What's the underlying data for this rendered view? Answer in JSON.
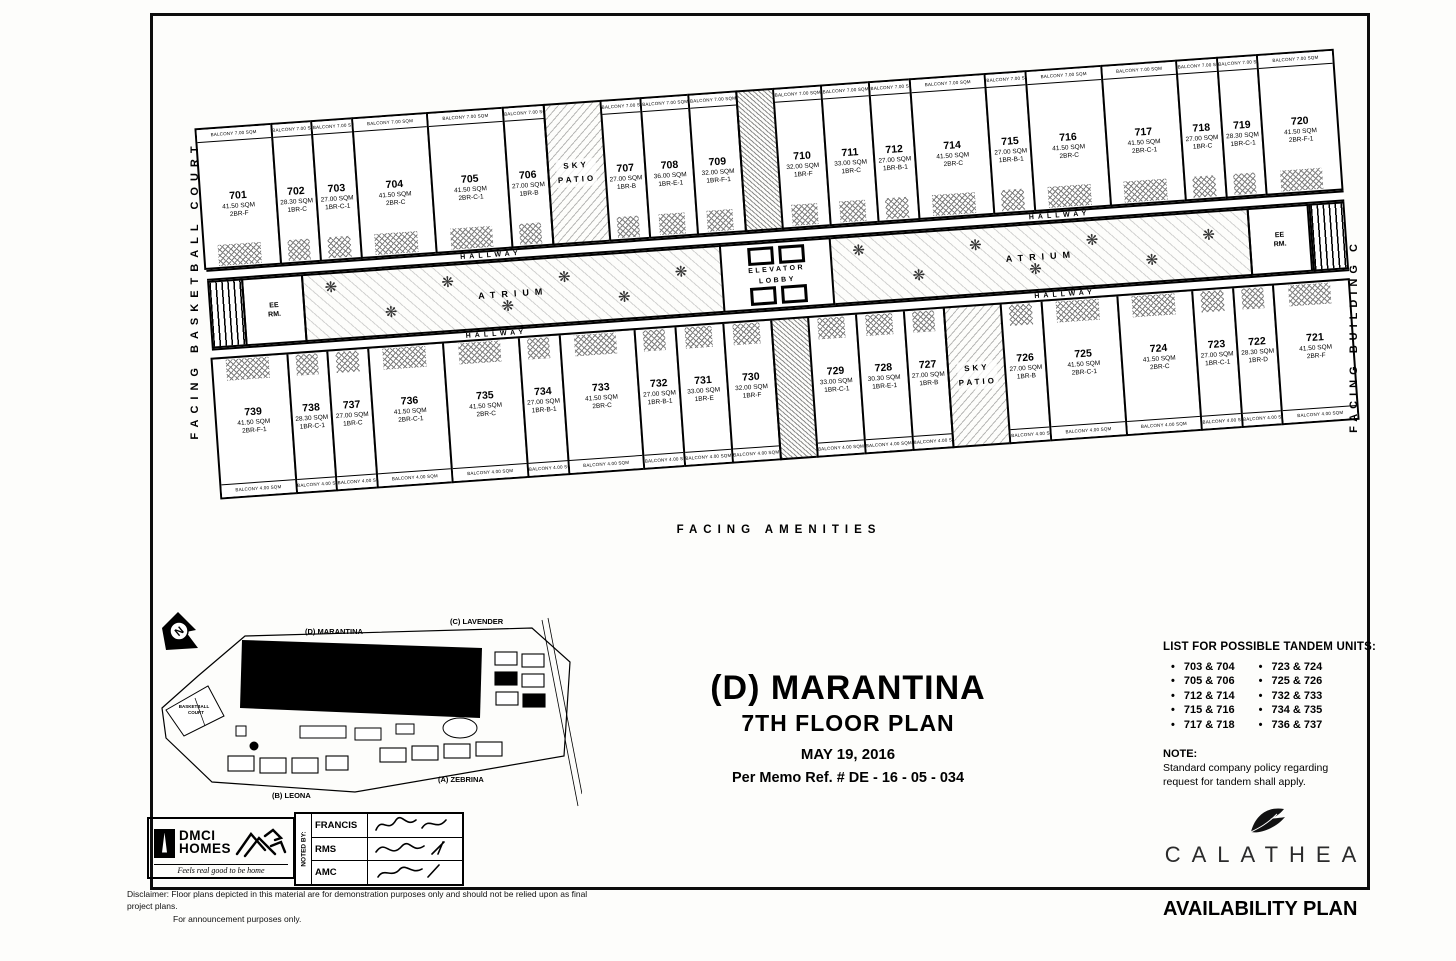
{
  "doc": {
    "title": "(D) MARANTINA",
    "subtitle": "7TH FLOOR PLAN",
    "date": "MAY 19, 2016",
    "memo": "Per Memo Ref. #  DE - 16 - 05 - 034"
  },
  "edges": {
    "left": "FACING BASKETBALL COURT",
    "right": "FACING BUILDING C",
    "bottom": "FACING AMENITIES"
  },
  "plan": {
    "hallway": "HALLWAY",
    "atrium": "ATRIUM",
    "elevator": "ELEVATOR",
    "lobby": "LOBBY",
    "ee_room": "EE RM.",
    "balcony_top": "BALCONY 7.00 SQM",
    "balcony_bottom": "BALCONY 4.00 SQM",
    "top_units": [
      {
        "no": "701",
        "area": "41.50 SQM",
        "type": "2BR-F"
      },
      {
        "no": "702",
        "area": "28.30 SQM",
        "type": "1BR-C"
      },
      {
        "no": "703",
        "area": "27.00 SQM",
        "type": "1BR-C-1"
      },
      {
        "no": "704",
        "area": "41.50 SQM",
        "type": "2BR-C"
      },
      {
        "no": "705",
        "area": "41.50 SQM",
        "type": "2BR-C-1"
      },
      {
        "no": "706",
        "area": "27.00 SQM",
        "type": "1BR-B"
      },
      {
        "kind": "sky",
        "label": "SKY PATIO"
      },
      {
        "no": "707",
        "area": "27.00 SQM",
        "type": "1BR-B"
      },
      {
        "no": "708",
        "area": "36.00 SQM",
        "type": "1BR-E-1"
      },
      {
        "no": "709",
        "area": "32.00 SQM",
        "type": "1BR-F-1"
      },
      {
        "kind": "core"
      },
      {
        "no": "710",
        "area": "32.00 SQM",
        "type": "1BR-F"
      },
      {
        "no": "711",
        "area": "33.00 SQM",
        "type": "1BR-C"
      },
      {
        "no": "712",
        "area": "27.00 SQM",
        "type": "1BR-B-1"
      },
      {
        "no": "714",
        "area": "41.50 SQM",
        "type": "2BR-C"
      },
      {
        "no": "715",
        "area": "27.00 SQM",
        "type": "1BR-B-1"
      },
      {
        "no": "716",
        "area": "41.50 SQM",
        "type": "2BR-C"
      },
      {
        "no": "717",
        "area": "41.50 SQM",
        "type": "2BR-C-1"
      },
      {
        "no": "718",
        "area": "27.00 SQM",
        "type": "1BR-C"
      },
      {
        "no": "719",
        "area": "28.30 SQM",
        "type": "1BR-C-1"
      },
      {
        "no": "720",
        "area": "41.50 SQM",
        "type": "2BR-F-1"
      }
    ],
    "bottom_units": [
      {
        "no": "739",
        "area": "41.50 SQM",
        "type": "2BR-F-1"
      },
      {
        "no": "738",
        "area": "28.30 SQM",
        "type": "1BR-C-1"
      },
      {
        "no": "737",
        "area": "27.00 SQM",
        "type": "1BR-C"
      },
      {
        "no": "736",
        "area": "41.50 SQM",
        "type": "2BR-C-1"
      },
      {
        "no": "735",
        "area": "41.50 SQM",
        "type": "2BR-C"
      },
      {
        "no": "734",
        "area": "27.00 SQM",
        "type": "1BR-B-1"
      },
      {
        "no": "733",
        "area": "41.50 SQM",
        "type": "2BR-C"
      },
      {
        "no": "732",
        "area": "27.00 SQM",
        "type": "1BR-B-1"
      },
      {
        "no": "731",
        "area": "33.00 SQM",
        "type": "1BR-E"
      },
      {
        "no": "730",
        "area": "32.00 SQM",
        "type": "1BR-F"
      },
      {
        "kind": "core"
      },
      {
        "no": "729",
        "area": "33.00 SQM",
        "type": "1BR-C-1"
      },
      {
        "no": "728",
        "area": "30.30 SQM",
        "type": "1BR-E-1"
      },
      {
        "no": "727",
        "area": "27.00 SQM",
        "type": "1BR-B"
      },
      {
        "kind": "sky",
        "label": "SKY PATIO"
      },
      {
        "no": "726",
        "area": "27.00 SQM",
        "type": "1BR-B"
      },
      {
        "no": "725",
        "area": "41.50 SQM",
        "type": "2BR-C-1"
      },
      {
        "no": "724",
        "area": "41.50 SQM",
        "type": "2BR-C"
      },
      {
        "no": "723",
        "area": "27.00 SQM",
        "type": "1BR-C-1"
      },
      {
        "no": "722",
        "area": "28.30 SQM",
        "type": "1BR-D"
      },
      {
        "no": "721",
        "area": "41.50 SQM",
        "type": "2BR-F"
      }
    ]
  },
  "sitemap": {
    "north": "N",
    "marantina": "(D) MARANTINA",
    "lavender": "(C) LAVENDER",
    "zebrina": "(A) ZEBRINA",
    "leona": "(B) LEONA",
    "basketball1": "BASKETBALL",
    "basketball2": "COURT"
  },
  "tandem": {
    "title": "LIST FOR POSSIBLE TANDEM UNITS:",
    "col1": [
      "703 & 704",
      "705 & 706",
      "712 & 714",
      "715 & 716",
      "717 & 718"
    ],
    "col2": [
      "723 & 724",
      "725 & 726",
      "732 & 733",
      "734 & 735",
      "736 & 737"
    ],
    "note_title": "NOTE:",
    "note_body": "Standard company policy regarding request for tandem shall apply."
  },
  "branding": {
    "dmci": "DMCI",
    "homes": "HOMES",
    "tagline": "Feels real good to be home",
    "noted_by": "NOTED BY:",
    "signers": [
      "FRANCIS",
      "RMS",
      "AMC"
    ],
    "calathea": "CALATHEA",
    "availability": "AVAILABILITY PLAN"
  },
  "disclaimer": {
    "line1": "Disclaimer:  Floor plans depicted in this material are for demonstration purposes only and should not be relied upon as final project plans.",
    "line2": "For announcement purposes only."
  }
}
